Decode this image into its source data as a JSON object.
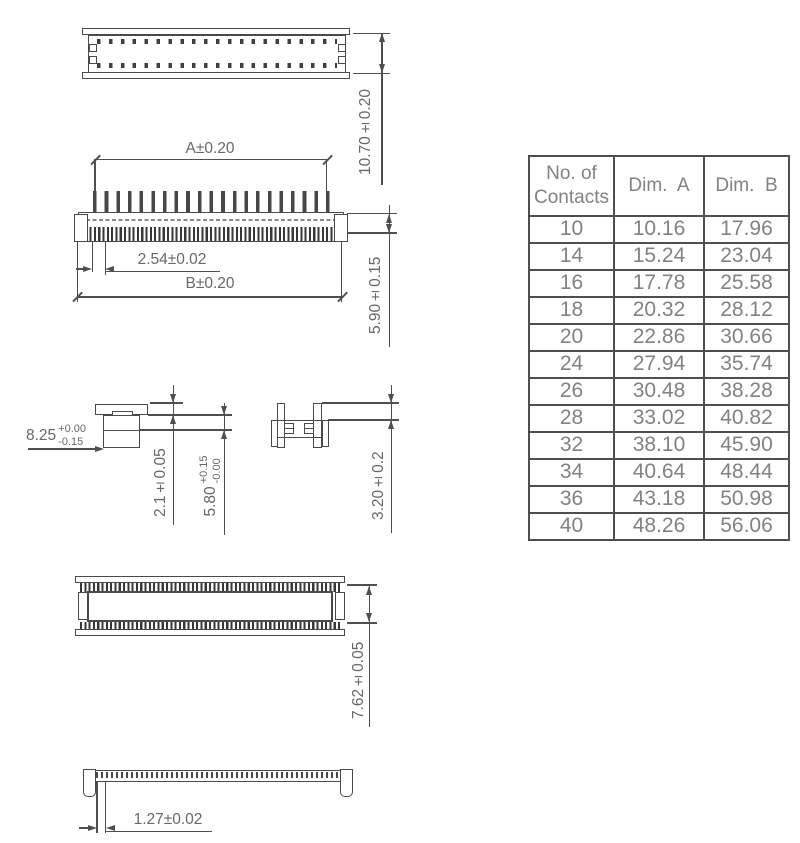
{
  "table": {
    "header_contacts": "No. of\nContacts",
    "header_dim_a": "Dim.  A",
    "header_dim_b": "Dim.  B",
    "rows": [
      [
        "10",
        "10.16",
        "17.96"
      ],
      [
        "14",
        "15.24",
        "23.04"
      ],
      [
        "16",
        "17.78",
        "25.58"
      ],
      [
        "18",
        "20.32",
        "28.12"
      ],
      [
        "20",
        "22.86",
        "30.66"
      ],
      [
        "24",
        "27.94",
        "35.74"
      ],
      [
        "26",
        "30.48",
        "38.28"
      ],
      [
        "28",
        "33.02",
        "40.82"
      ],
      [
        "32",
        "38.10",
        "45.90"
      ],
      [
        "34",
        "40.64",
        "48.44"
      ],
      [
        "36",
        "43.18",
        "50.98"
      ],
      [
        "40",
        "48.26",
        "56.06"
      ]
    ]
  },
  "dimensions": {
    "height_top": "10.70±0.20",
    "dim_a": "A±0.20",
    "pitch": "2.54±0.02",
    "dim_b": "B±0.20",
    "front_height": "5.90±0.15",
    "side_width": {
      "value": "8.25",
      "plus": "+0.00",
      "minus": "-0.15"
    },
    "cap_height": "2.1±0.05",
    "mated_height": {
      "value": "5.80",
      "plus": "+0.15",
      "minus": "-0.00"
    },
    "post_height": "3.20±0.2",
    "rear_height": "7.62±0.05",
    "row_pitch": "1.27±0.02"
  },
  "colors": {
    "line": "#4a4a4a",
    "dim_text": "#686868",
    "table_text": "#828282"
  }
}
